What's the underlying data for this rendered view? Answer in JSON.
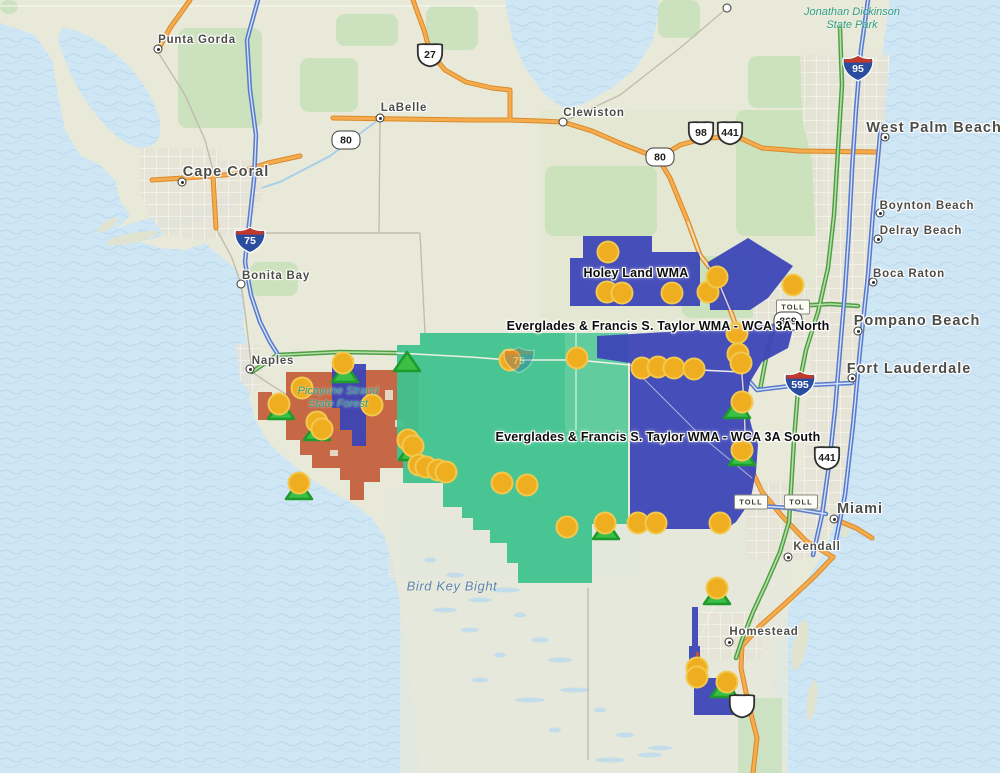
{
  "colors": {
    "water": "#cfe6f5",
    "water_wave": "#b7d6ec",
    "land": "#e8e9d8",
    "land_pale": "#e4e7db",
    "urban": "#e6e3d6",
    "urban_street": "#f7f6ef",
    "park_green": "#c7e0ba",
    "wma_blue": "#3c44b7",
    "wma_teal": "#3fc28f",
    "wma_rust": "#c4603c",
    "road_orange": "#f6ac4e",
    "road_orange_casing": "#d98a28",
    "road_blue": "#5a7bcd",
    "road_blue_inner": "#d6e4fa",
    "road_green": "#4f9e46",
    "road_green_inner": "#b5dfa8",
    "road_minor": "#bdb9a8",
    "marker_fill": "#efae20",
    "marker_stroke": "#f2c94e",
    "triangle_fill": "#3bbf46",
    "triangle_stroke": "#1d9b2c",
    "label_city": "#4c4c48",
    "label_water": "#5f84ab",
    "label_park": "#2f9e85",
    "shield_blue": "#2b4da0",
    "shield_red": "#c0392b"
  },
  "map": {
    "cities": [
      {
        "name": "Punta Gorda",
        "lx": 197,
        "ly": 40,
        "size": "md",
        "dot": {
          "x": 158,
          "y": 49,
          "type": "town"
        }
      },
      {
        "name": "Cape Coral",
        "lx": 226,
        "ly": 172,
        "size": "lg",
        "dot": {
          "x": 182,
          "y": 182,
          "type": "town"
        }
      },
      {
        "name": "LaBelle",
        "lx": 404,
        "ly": 108,
        "size": "md",
        "dot": {
          "x": 380,
          "y": 118,
          "type": "town"
        }
      },
      {
        "name": "Clewiston",
        "lx": 594,
        "ly": 113,
        "size": "md",
        "dot": {
          "x": 563,
          "y": 122,
          "type": "open"
        }
      },
      {
        "name": "West Palm Beach",
        "lx": 934,
        "ly": 128,
        "size": "lg",
        "dot": {
          "x": 885,
          "y": 137,
          "type": "town"
        }
      },
      {
        "name": "Boynton Beach",
        "lx": 927,
        "ly": 206,
        "size": "md",
        "dot": {
          "x": 880,
          "y": 213,
          "type": "town"
        }
      },
      {
        "name": "Delray Beach",
        "lx": 921,
        "ly": 231,
        "size": "md",
        "dot": {
          "x": 878,
          "y": 239,
          "type": "town"
        }
      },
      {
        "name": "Boca Raton",
        "lx": 909,
        "ly": 274,
        "size": "md",
        "dot": {
          "x": 873,
          "y": 282,
          "type": "town"
        }
      },
      {
        "name": "Pompano Beach",
        "lx": 917,
        "ly": 321,
        "size": "lg",
        "dot": {
          "x": 858,
          "y": 331,
          "type": "town"
        }
      },
      {
        "name": "Fort Lauderdale",
        "lx": 909,
        "ly": 369,
        "size": "lg",
        "dot": {
          "x": 852,
          "y": 378,
          "type": "town"
        }
      },
      {
        "name": "Miami",
        "lx": 860,
        "ly": 509,
        "size": "lg",
        "dot": {
          "x": 834,
          "y": 519,
          "type": "town"
        }
      },
      {
        "name": "Kendall",
        "lx": 817,
        "ly": 547,
        "size": "md",
        "dot": {
          "x": 788,
          "y": 557,
          "type": "town"
        }
      },
      {
        "name": "Homestead",
        "lx": 764,
        "ly": 632,
        "size": "md",
        "dot": {
          "x": 729,
          "y": 642,
          "type": "town"
        }
      },
      {
        "name": "Bonita Bay",
        "lx": 276,
        "ly": 276,
        "size": "md",
        "dot": {
          "x": 241,
          "y": 284,
          "type": "open"
        }
      },
      {
        "name": "Naples",
        "lx": 273,
        "ly": 361,
        "size": "md",
        "dot": {
          "x": 250,
          "y": 369,
          "type": "town"
        }
      }
    ],
    "extra_dots": [
      {
        "x": 727,
        "y": 8,
        "type": "open"
      }
    ],
    "area_labels": [
      {
        "text": "Holey Land WMA",
        "x": 636,
        "y": 273
      },
      {
        "text": "Everglades & Francis S. Taylor WMA - WCA 3A North",
        "x": 668,
        "y": 326
      },
      {
        "text": "Everglades & Francis S. Taylor WMA - WCA 3A South",
        "x": 658,
        "y": 437
      }
    ],
    "water_labels": [
      {
        "text": "Bird Key Bight",
        "x": 452,
        "y": 586
      }
    ],
    "park_labels": [
      {
        "lines": [
          "Jonathan Dickinson",
          "State Park"
        ],
        "x": 852,
        "y": 6
      },
      {
        "lines": [
          "Picayune Strand",
          "State Forest"
        ],
        "x": 338,
        "y": 385
      }
    ],
    "shields": [
      {
        "type": "us",
        "text": "27",
        "x": 430,
        "y": 55
      },
      {
        "type": "sr",
        "text": "80",
        "x": 346,
        "y": 140
      },
      {
        "type": "sr",
        "text": "80",
        "x": 660,
        "y": 157
      },
      {
        "type": "us",
        "text": "98",
        "x": 701,
        "y": 133
      },
      {
        "type": "us",
        "text": "441",
        "x": 730,
        "y": 133
      },
      {
        "type": "interstate",
        "text": "95",
        "x": 858,
        "y": 68
      },
      {
        "type": "interstate",
        "text": "75",
        "x": 250,
        "y": 240
      },
      {
        "type": "interstate",
        "text": "75",
        "x": 519,
        "y": 360,
        "faded": true
      },
      {
        "type": "interstate",
        "text": "595",
        "x": 800,
        "y": 384
      },
      {
        "type": "us",
        "text": "441",
        "x": 827,
        "y": 458
      },
      {
        "type": "toll",
        "text": "TOLL",
        "x": 793,
        "y": 307
      },
      {
        "type": "sr",
        "text": "869",
        "x": 788,
        "y": 321
      },
      {
        "type": "toll",
        "text": "TOLL",
        "x": 751,
        "y": 502
      },
      {
        "type": "toll",
        "text": "TOLL",
        "x": 801,
        "y": 502
      },
      {
        "type": "us",
        "text": "",
        "x": 742,
        "y": 706
      }
    ],
    "wma_markers": [
      [
        608,
        252
      ],
      [
        607,
        292
      ],
      [
        622,
        293
      ],
      [
        672,
        293
      ],
      [
        708,
        292
      ],
      [
        717,
        277
      ],
      [
        793,
        285
      ],
      [
        737,
        333
      ],
      [
        738,
        354
      ],
      [
        741,
        363
      ],
      [
        742,
        402
      ],
      [
        742,
        450
      ],
      [
        510,
        360
      ],
      [
        577,
        358
      ],
      [
        642,
        368
      ],
      [
        658,
        367
      ],
      [
        674,
        368
      ],
      [
        694,
        369
      ],
      [
        343,
        363
      ],
      [
        302,
        388
      ],
      [
        279,
        404
      ],
      [
        372,
        405
      ],
      [
        317,
        422
      ],
      [
        322,
        429
      ],
      [
        408,
        440
      ],
      [
        413,
        446
      ],
      [
        419,
        465
      ],
      [
        426,
        467
      ],
      [
        438,
        470
      ],
      [
        446,
        472
      ],
      [
        502,
        483
      ],
      [
        527,
        485
      ],
      [
        567,
        527
      ],
      [
        605,
        523
      ],
      [
        638,
        523
      ],
      [
        656,
        523
      ],
      [
        720,
        523
      ],
      [
        299,
        483
      ],
      [
        717,
        588
      ],
      [
        697,
        668
      ],
      [
        697,
        677
      ],
      [
        727,
        682
      ]
    ],
    "campground_markers": [
      [
        345,
        374
      ],
      [
        407,
        363
      ],
      [
        281,
        411
      ],
      [
        317,
        432
      ],
      [
        412,
        452
      ],
      [
        299,
        491
      ],
      [
        606,
        531
      ],
      [
        737,
        410
      ],
      [
        742,
        457
      ],
      [
        717,
        596
      ],
      [
        724,
        689
      ]
    ]
  }
}
